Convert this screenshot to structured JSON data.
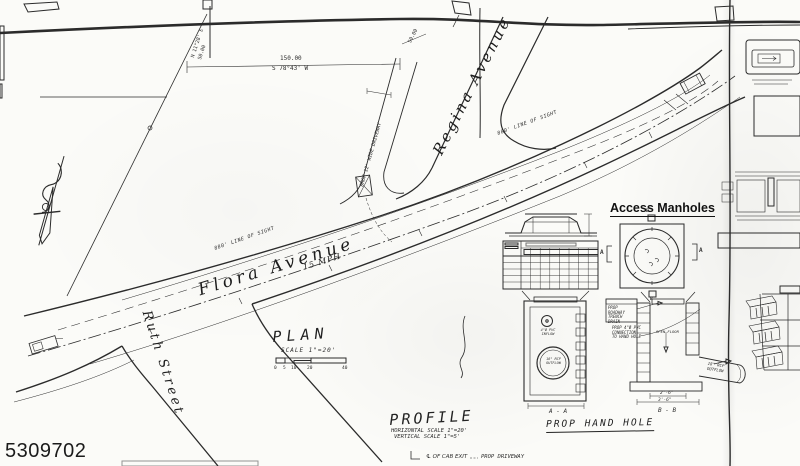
{
  "sheet": {
    "id": "5309702"
  },
  "plan": {
    "title": "PLAN",
    "scale_note": "SCALE 1\"=20'",
    "scale_bar_ticks": [
      "0",
      "5",
      "10",
      "20",
      "40"
    ],
    "streets": {
      "flora_avenue": "Flora Avenue",
      "flora_speed_limit": "15 MPH",
      "regina_avenue": "Regina Avenue",
      "ruth_street": "Ruth Street"
    },
    "dimensions": {
      "frontage_length": "150.00",
      "frontage_bearing": "S 78°43' W",
      "side_bearing": "N 11°28' E",
      "side_length": "50.00"
    },
    "annotations": {
      "sight_line_left": "880' LINE OF SIGHT",
      "sight_line_right": "880' LINE OF SIGHT",
      "driveway_label": "PROP 12' WIDE DRIVEWAY"
    }
  },
  "profile": {
    "title": "PROFILE",
    "horizontal_scale": "HORIZONTAL SCALE 1\"=20'",
    "vertical_scale": "VERTICAL SCALE 1\"=5'"
  },
  "access_manholes": {
    "title": "Access Manholes",
    "marker_a_left": "A",
    "marker_a_right": "A",
    "marker_b_top": "B",
    "marker_b_bottom": "B"
  },
  "hand_hole": {
    "title": "PROP HAND HOLE",
    "section_a_label": "A - A",
    "section_b_label": "B - B",
    "callout_trench_drain": "PROP ROADWAY TRENCH DRAIN",
    "callout_pvc_connection": "PROP 4\"Ø PVC CONNECTION TO HAND HOLE",
    "inflow_label": "4\"Ø PVC INFLOW",
    "outflow_label_a": "18\" RCP OUTFLOW",
    "outflow_label_b": "18\" RCP OUTFLOW",
    "open_floor_label": "OPEN FLOOR",
    "dim_inner_width": "2'-6\"",
    "dim_outer_width": "3'-6\""
  },
  "legend": {
    "cab_exit": "℄ OF CAB EXIT",
    "prop_driveway": "PROP DRIVEWAY"
  }
}
